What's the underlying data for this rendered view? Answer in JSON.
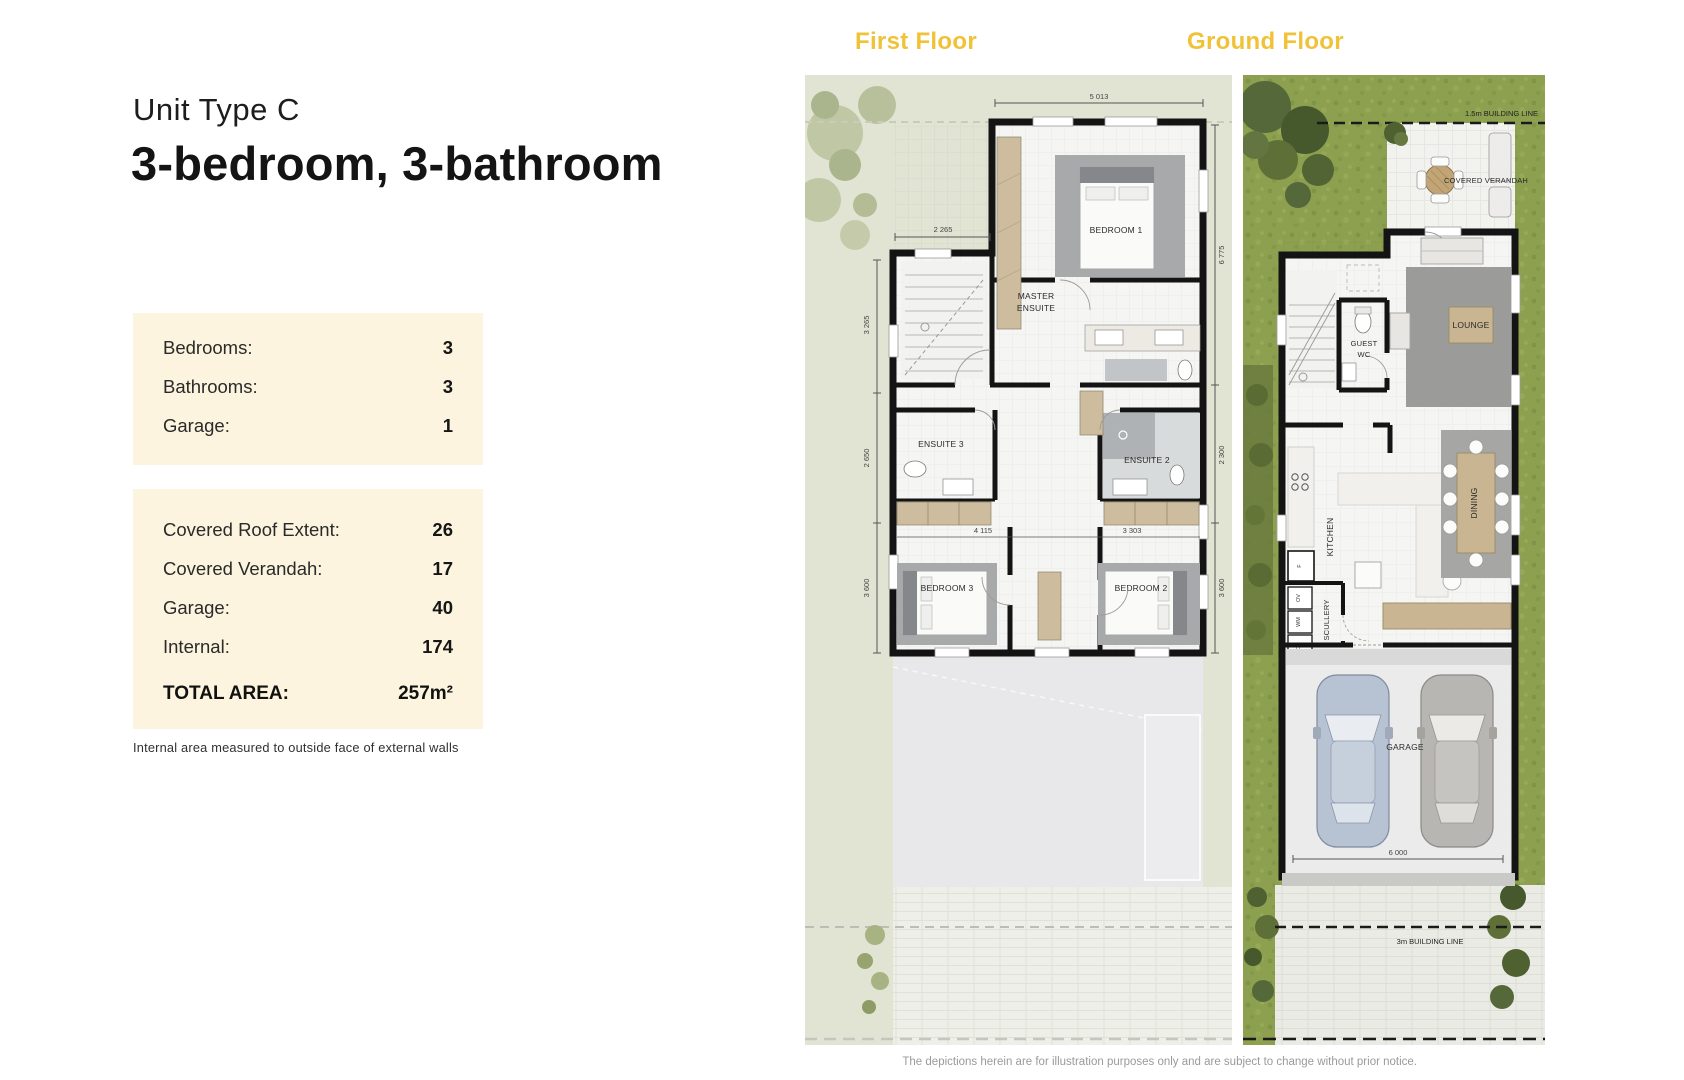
{
  "header": {
    "title_small": "Unit Type C",
    "title_large": "3-bedroom, 3-bathroom"
  },
  "specs": {
    "rows": [
      {
        "label": "Bedrooms:",
        "value": "3"
      },
      {
        "label": "Bathrooms:",
        "value": "3"
      },
      {
        "label": "Garage:",
        "value": "1"
      }
    ]
  },
  "areas": {
    "rows": [
      {
        "label": "Covered Roof Extent:",
        "value": "26"
      },
      {
        "label": "Covered Verandah:",
        "value": "17"
      },
      {
        "label": "Garage:",
        "value": "40"
      },
      {
        "label": "Internal:",
        "value": "174"
      }
    ],
    "total_label": "TOTAL AREA:",
    "total_value": "257m²"
  },
  "footnote": "Internal area measured to outside face of external walls",
  "first_floor": {
    "heading": "First Floor",
    "labels": {
      "bedroom1": "BEDROOM 1",
      "master_l1": "MASTER",
      "master_l2": "ENSUITE",
      "ensuite3": "ENSUITE 3",
      "ensuite2": "ENSUITE 2",
      "bedroom3": "BEDROOM 3",
      "bedroom2": "BEDROOM 2"
    },
    "dims": {
      "top": "5 013",
      "stair_width": "2 265",
      "left1": "3 265",
      "left2": "2 650",
      "left3": "3 600",
      "right1": "6 775",
      "right2": "2 300",
      "right3": "3 600",
      "inner_left": "4 115",
      "inner_right": "3 303"
    }
  },
  "ground_floor": {
    "heading": "Ground Floor",
    "labels": {
      "building_line_top": "1.5m BUILDING LINE",
      "covered_verandah": "COVERED VERANDAH",
      "guest_l1": "GUEST",
      "guest_l2": "WC",
      "lounge": "LOUNGE",
      "kitchen": "KITCHEN",
      "scullery": "SCULLERY",
      "dining": "DINING",
      "garage": "GARAGE",
      "building_line_bottom": "3m BUILDING LINE",
      "fridge": "F",
      "oven": "OV",
      "washer": "WM",
      "dryer": "DR"
    },
    "dims": {
      "garage_width": "6 000"
    }
  },
  "footer": {
    "disclaimer": "The depictions herein are for illustration purposes only and are subject to change without prior notice."
  },
  "colors": {
    "accent_gold": "#F0C238",
    "panel_cream": "#FCF4DE",
    "wall_black": "#141414",
    "sage_bg": "#E1E4D3",
    "grass_green": "#8CA04F"
  }
}
